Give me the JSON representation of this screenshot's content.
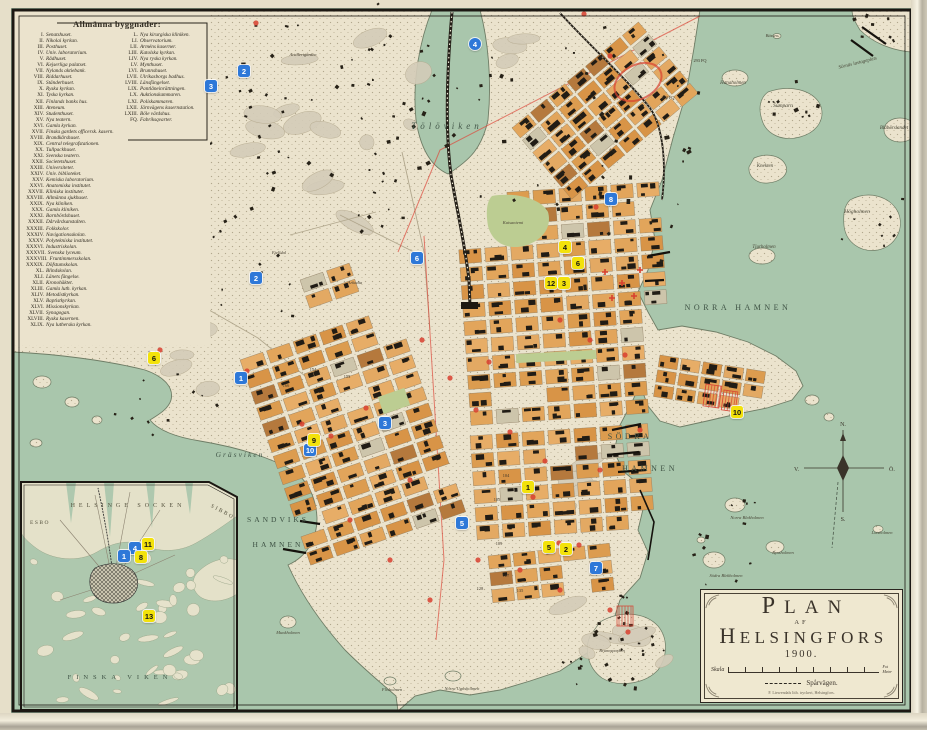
{
  "colors": {
    "water": "#a9c6ac",
    "land": "#ebe3cd",
    "block_orange": "#dfa258",
    "building": "#211c15",
    "marker_blue": "#2e78d8",
    "marker_yellow": "#f3e20b",
    "red_annotation": "#d8402f",
    "frame": "#1c1813"
  },
  "legend": {
    "title": "Allmänna byggnader:",
    "left_items": [
      {
        "n": "I.",
        "t": "Senatshuset."
      },
      {
        "n": "II.",
        "t": "Nikolai kyrkan."
      },
      {
        "n": "III.",
        "t": "Posthuset."
      },
      {
        "n": "IV.",
        "t": "Univ. laboratorium."
      },
      {
        "n": "V.",
        "t": "Rådhuset."
      },
      {
        "n": "VI.",
        "t": "Kejserliga palatset."
      },
      {
        "n": "VII.",
        "t": "Nylands aktiebank."
      },
      {
        "n": "VIII.",
        "t": "Riddarhuset."
      },
      {
        "n": "IX.",
        "t": "Ständerhuset."
      },
      {
        "n": "X.",
        "t": "Ryska kyrkan."
      },
      {
        "n": "XI.",
        "t": "Tyska kyrkan."
      },
      {
        "n": "XII.",
        "t": "Finlands banks hus."
      },
      {
        "n": "XIII.",
        "t": "Ateneum."
      },
      {
        "n": "XIV.",
        "t": "Studenthuset."
      },
      {
        "n": "XV.",
        "t": "Nya teatern."
      },
      {
        "n": "XVI.",
        "t": "Gamla kyrkan."
      },
      {
        "n": "XVII.",
        "t": "Finska gardets officersk. kasern."
      },
      {
        "n": "XVIII.",
        "t": "Brandkårshuset."
      },
      {
        "n": "XIX.",
        "t": "Central telegrafstationen."
      },
      {
        "n": "XX.",
        "t": "Tullpackhuset."
      },
      {
        "n": "XXI.",
        "t": "Svenska teatern."
      },
      {
        "n": "XXII.",
        "t": "Societetshuset."
      },
      {
        "n": "XXIII.",
        "t": "Universitetet."
      },
      {
        "n": "XXIV.",
        "t": "Univ. biblioteket."
      },
      {
        "n": "XXV.",
        "t": "Kemiska laboratorium."
      },
      {
        "n": "XXVI.",
        "t": "Anatomiska institutet."
      },
      {
        "n": "XXVII.",
        "t": "Kliniska institutet."
      },
      {
        "n": "XXVIII.",
        "t": "Allmänna sjukhuset."
      },
      {
        "n": "XXIX.",
        "t": "Nya kliniken."
      },
      {
        "n": "XXX.",
        "t": "Gamla kliniken."
      },
      {
        "n": "XXXI.",
        "t": "Barnbördshuset."
      },
      {
        "n": "XXXII.",
        "t": "Dårvårdsanstalten."
      },
      {
        "n": "XXXIII.",
        "t": "Folkskolor."
      },
      {
        "n": "XXXIV.",
        "t": "Navigationsskolan."
      },
      {
        "n": "XXXV.",
        "t": "Polytekniska institutet."
      },
      {
        "n": "XXXVI.",
        "t": "Industriskolan."
      },
      {
        "n": "XXXVII.",
        "t": "Svenska lyceum."
      },
      {
        "n": "XXXVIII.",
        "t": "Fruntimmersskolan."
      },
      {
        "n": "XXXIX.",
        "t": "Döfstumskolan."
      },
      {
        "n": "XL.",
        "t": "Blindskolan."
      },
      {
        "n": "XLI.",
        "t": "Länets fängelse."
      },
      {
        "n": "XLII.",
        "t": "Kronohäktet."
      },
      {
        "n": "XLIII.",
        "t": "Gamla luth. kyrkan."
      },
      {
        "n": "XLIV.",
        "t": "Metodistkyrkan."
      },
      {
        "n": "XLV.",
        "t": "Baptistkyrkan."
      },
      {
        "n": "XLVI.",
        "t": "Missionskyrkan."
      },
      {
        "n": "XLVII.",
        "t": "Synagogan."
      },
      {
        "n": "XLVIII.",
        "t": "Ryska kasernen."
      },
      {
        "n": "XLIX.",
        "t": "Nya lutherska kyrkan."
      }
    ],
    "right_items": [
      {
        "n": "L.",
        "t": "Nya kirurgiska kliniken."
      },
      {
        "n": "LI.",
        "t": "Observatorium."
      },
      {
        "n": "LII.",
        "t": "Arméns kaserner."
      },
      {
        "n": "LIII.",
        "t": "Katolska kyrkan."
      },
      {
        "n": "LIV.",
        "t": "Nya ryska kyrkan."
      },
      {
        "n": "LV.",
        "t": "Mynthuset."
      },
      {
        "n": "LVI.",
        "t": "Brunnshuset."
      },
      {
        "n": "LVII.",
        "t": "Ulrikasborgs badhus."
      },
      {
        "n": "LVIII.",
        "t": "Länsfängelset."
      },
      {
        "n": "LIX.",
        "t": "Pantlåneinrättningen."
      },
      {
        "n": "LX.",
        "t": "Auktionskammaren."
      },
      {
        "n": "LXI.",
        "t": "Poliskammaren."
      },
      {
        "n": "LXII.",
        "t": "Järnvägens kasernstation."
      },
      {
        "n": "LXIII.",
        "t": "Böle värdshus."
      },
      {
        "n": "FQ.",
        "t": "Fabriksqvarter."
      }
    ]
  },
  "labels": {
    "main": [
      {
        "t": "Tölöviken",
        "x": 447,
        "y": 129,
        "s": 9,
        "sp": 4,
        "st": "sea"
      },
      {
        "t": "Edesviken",
        "x": 150,
        "y": 168,
        "s": 7.5,
        "sp": 2.5,
        "st": "sea"
      },
      {
        "t": "Lappviken",
        "x": 155,
        "y": 313,
        "s": 7.5,
        "sp": 2,
        "st": "sea"
      },
      {
        "t": "Gräsviken",
        "x": 240,
        "y": 457,
        "s": 7.5,
        "sp": 2,
        "st": "sea"
      },
      {
        "t": "SANDVIKS",
        "x": 278,
        "y": 522,
        "s": 7.5,
        "sp": 3,
        "st": "SEA"
      },
      {
        "t": "HAMNEN",
        "x": 278,
        "y": 547,
        "s": 7.5,
        "sp": 3,
        "st": "SEA"
      },
      {
        "t": "NORRA HAMNEN",
        "x": 738,
        "y": 310,
        "s": 8,
        "sp": 3.5,
        "st": "SEA"
      },
      {
        "t": "SÖDRA",
        "x": 630,
        "y": 439,
        "s": 8,
        "sp": 3.5,
        "st": "SEA"
      },
      {
        "t": "HAMNEN",
        "x": 650,
        "y": 471,
        "s": 8,
        "sp": 3.5,
        "st": "SEA"
      },
      {
        "t": "Hanaholmen",
        "x": 733,
        "y": 84,
        "s": 5,
        "st": "isl"
      },
      {
        "t": "Sörnäs lastageplats",
        "x": 858,
        "y": 64,
        "s": 5,
        "st": "isl",
        "r": -14
      },
      {
        "t": "Sumparn",
        "x": 783,
        "y": 107,
        "s": 5.5,
        "st": "isl"
      },
      {
        "t": "Blåbärslandet",
        "x": 894,
        "y": 129,
        "s": 5,
        "st": "isl"
      },
      {
        "t": "Knekten",
        "x": 765,
        "y": 167,
        "s": 5,
        "st": "isl"
      },
      {
        "t": "Högholmen",
        "x": 857,
        "y": 213,
        "s": 5.5,
        "st": "isl"
      },
      {
        "t": "Tjurholmen",
        "x": 764,
        "y": 248,
        "s": 5,
        "st": "isl"
      },
      {
        "t": "Bässen",
        "x": 772,
        "y": 37,
        "s": 4.5,
        "st": "isl"
      },
      {
        "t": "Norra Blekholmen",
        "x": 747,
        "y": 519,
        "s": 4.5,
        "st": "isl"
      },
      {
        "t": "Södra Blekholmen",
        "x": 726,
        "y": 577,
        "s": 4.5,
        "st": "isl"
      },
      {
        "t": "Ryssholmen",
        "x": 783,
        "y": 554,
        "s": 4.5,
        "st": "isl"
      },
      {
        "t": "Lotsholmen",
        "x": 882,
        "y": 534,
        "s": 4.5,
        "st": "isl"
      },
      {
        "t": "Munkholmen",
        "x": 288,
        "y": 634,
        "s": 4.5,
        "st": "isl"
      },
      {
        "t": "Flisholmen",
        "x": 392,
        "y": 691,
        "s": 4.5,
        "st": "isl"
      },
      {
        "t": "Norra Ugnsholmen",
        "x": 462,
        "y": 690,
        "s": 4.5,
        "st": "isl"
      },
      {
        "t": "Artillerigården",
        "x": 303,
        "y": 56,
        "s": 4.5,
        "st": "land"
      },
      {
        "t": "Fjelldal",
        "x": 279,
        "y": 254,
        "s": 4.5,
        "st": "land"
      },
      {
        "t": "Arkadia",
        "x": 355,
        "y": 284,
        "s": 4.5,
        "st": "land"
      },
      {
        "t": "Kaisaniemi",
        "x": 513,
        "y": 224,
        "s": 4.5,
        "st": "land"
      },
      {
        "t": "Brunnsparken",
        "x": 612,
        "y": 652,
        "s": 4.5,
        "st": "land"
      }
    ],
    "inset": [
      {
        "t": "HELSINGE SOCKEN",
        "x": 128,
        "y": 507,
        "s": 6,
        "sp": 4,
        "st": "LAND"
      },
      {
        "t": "SIBBO",
        "x": 222,
        "y": 513,
        "s": 5.5,
        "sp": 2,
        "st": "LAND",
        "r": 28
      },
      {
        "t": "ESBO",
        "x": 40,
        "y": 524,
        "s": 5.5,
        "sp": 1.5,
        "st": "LAND"
      },
      {
        "t": "FINSKA VIKEN",
        "x": 120,
        "y": 679,
        "s": 6.5,
        "sp": 5,
        "st": "SEA"
      }
    ],
    "block_numbers": [
      [
        "154",
        313,
        371
      ],
      [
        "153",
        347,
        378
      ],
      [
        "166",
        286,
        387
      ],
      [
        "104",
        506,
        477
      ],
      [
        "105",
        497,
        501
      ],
      [
        "109",
        499,
        545
      ],
      [
        "127",
        506,
        577
      ],
      [
        "128",
        480,
        590
      ],
      [
        "135",
        520,
        592
      ],
      [
        "292 FQ",
        668,
        99
      ],
      [
        "293 FQ",
        700,
        62
      ],
      [
        "FQ",
        612,
        152
      ]
    ]
  },
  "markers": [
    {
      "c": "blue",
      "n": "2",
      "x": 244,
      "y": 71
    },
    {
      "c": "blue",
      "n": "3",
      "x": 211,
      "y": 86
    },
    {
      "c": "blue",
      "n": "4",
      "x": 475,
      "y": 44,
      "shape": "circle"
    },
    {
      "c": "blue",
      "n": "6",
      "x": 417,
      "y": 258
    },
    {
      "c": "blue",
      "n": "8",
      "x": 611,
      "y": 199
    },
    {
      "c": "blue",
      "n": "2",
      "x": 256,
      "y": 278
    },
    {
      "c": "blue",
      "n": "1",
      "x": 241,
      "y": 378
    },
    {
      "c": "blue",
      "n": "3",
      "x": 385,
      "y": 423
    },
    {
      "c": "blue",
      "n": "10",
      "x": 310,
      "y": 450
    },
    {
      "c": "blue",
      "n": "5",
      "x": 462,
      "y": 523
    },
    {
      "c": "blue",
      "n": "7",
      "x": 596,
      "y": 568
    },
    {
      "c": "blue",
      "n": "4",
      "x": 135,
      "y": 548
    },
    {
      "c": "blue",
      "n": "1",
      "x": 124,
      "y": 556
    },
    {
      "c": "yellow",
      "n": "4",
      "x": 565,
      "y": 247
    },
    {
      "c": "yellow",
      "n": "6",
      "x": 578,
      "y": 263
    },
    {
      "c": "yellow",
      "n": "12",
      "x": 551,
      "y": 283
    },
    {
      "c": "yellow",
      "n": "3",
      "x": 564,
      "y": 283
    },
    {
      "c": "yellow",
      "n": "6",
      "x": 154,
      "y": 358
    },
    {
      "c": "yellow",
      "n": "9",
      "x": 314,
      "y": 440
    },
    {
      "c": "yellow",
      "n": "1",
      "x": 528,
      "y": 487
    },
    {
      "c": "yellow",
      "n": "5",
      "x": 549,
      "y": 547
    },
    {
      "c": "yellow",
      "n": "2",
      "x": 566,
      "y": 549
    },
    {
      "c": "yellow",
      "n": "10",
      "x": 737,
      "y": 412
    },
    {
      "c": "yellow",
      "n": "11",
      "x": 148,
      "y": 544
    },
    {
      "c": "yellow",
      "n": "8",
      "x": 141,
      "y": 557
    },
    {
      "c": "yellow",
      "n": "13",
      "x": 149,
      "y": 616
    }
  ],
  "red_marks": {
    "dots": [
      [
        256,
        23
      ],
      [
        584,
        14
      ],
      [
        610,
        56
      ],
      [
        160,
        350
      ],
      [
        247,
        371
      ],
      [
        331,
        436
      ],
      [
        533,
        497
      ],
      [
        559,
        543
      ],
      [
        579,
        545
      ],
      [
        596,
        207
      ],
      [
        422,
        340
      ],
      [
        450,
        378
      ],
      [
        476,
        410
      ],
      [
        510,
        432
      ],
      [
        545,
        461
      ],
      [
        600,
        470
      ],
      [
        640,
        430
      ],
      [
        489,
        362
      ],
      [
        560,
        320
      ],
      [
        590,
        340
      ],
      [
        625,
        355
      ],
      [
        478,
        560
      ],
      [
        520,
        570
      ],
      [
        560,
        590
      ],
      [
        610,
        610
      ],
      [
        628,
        632
      ],
      [
        430,
        600
      ],
      [
        390,
        560
      ],
      [
        350,
        520
      ],
      [
        410,
        480
      ],
      [
        302,
        424
      ],
      [
        366,
        408
      ]
    ],
    "plusses": [
      [
        605,
        272
      ],
      [
        622,
        283
      ],
      [
        634,
        296
      ],
      [
        612,
        298
      ],
      [
        640,
        270
      ]
    ],
    "ellipse": {
      "x": 638,
      "y": 82,
      "rx": 25,
      "ry": 17,
      "rot": -28
    },
    "hatches": [
      [
        706,
        384,
        16,
        22,
        8
      ],
      [
        724,
        390,
        14,
        20,
        8
      ],
      [
        617,
        606,
        16,
        20,
        0
      ]
    ]
  },
  "compass": {
    "north": "N.",
    "south": "S.",
    "east": "Ö.",
    "west": "V."
  },
  "cartouche": {
    "title_line1": "Plan",
    "title_line2": "af",
    "title_line3": "Helsingfors",
    "year": "1900.",
    "scale_label": "Skala",
    "unit_top": "Fot",
    "unit_bottom": "Meter",
    "tram_label": "Spårvägen.",
    "imprint": "F. Liewendals lith. tryckeri, Helsingfors."
  }
}
